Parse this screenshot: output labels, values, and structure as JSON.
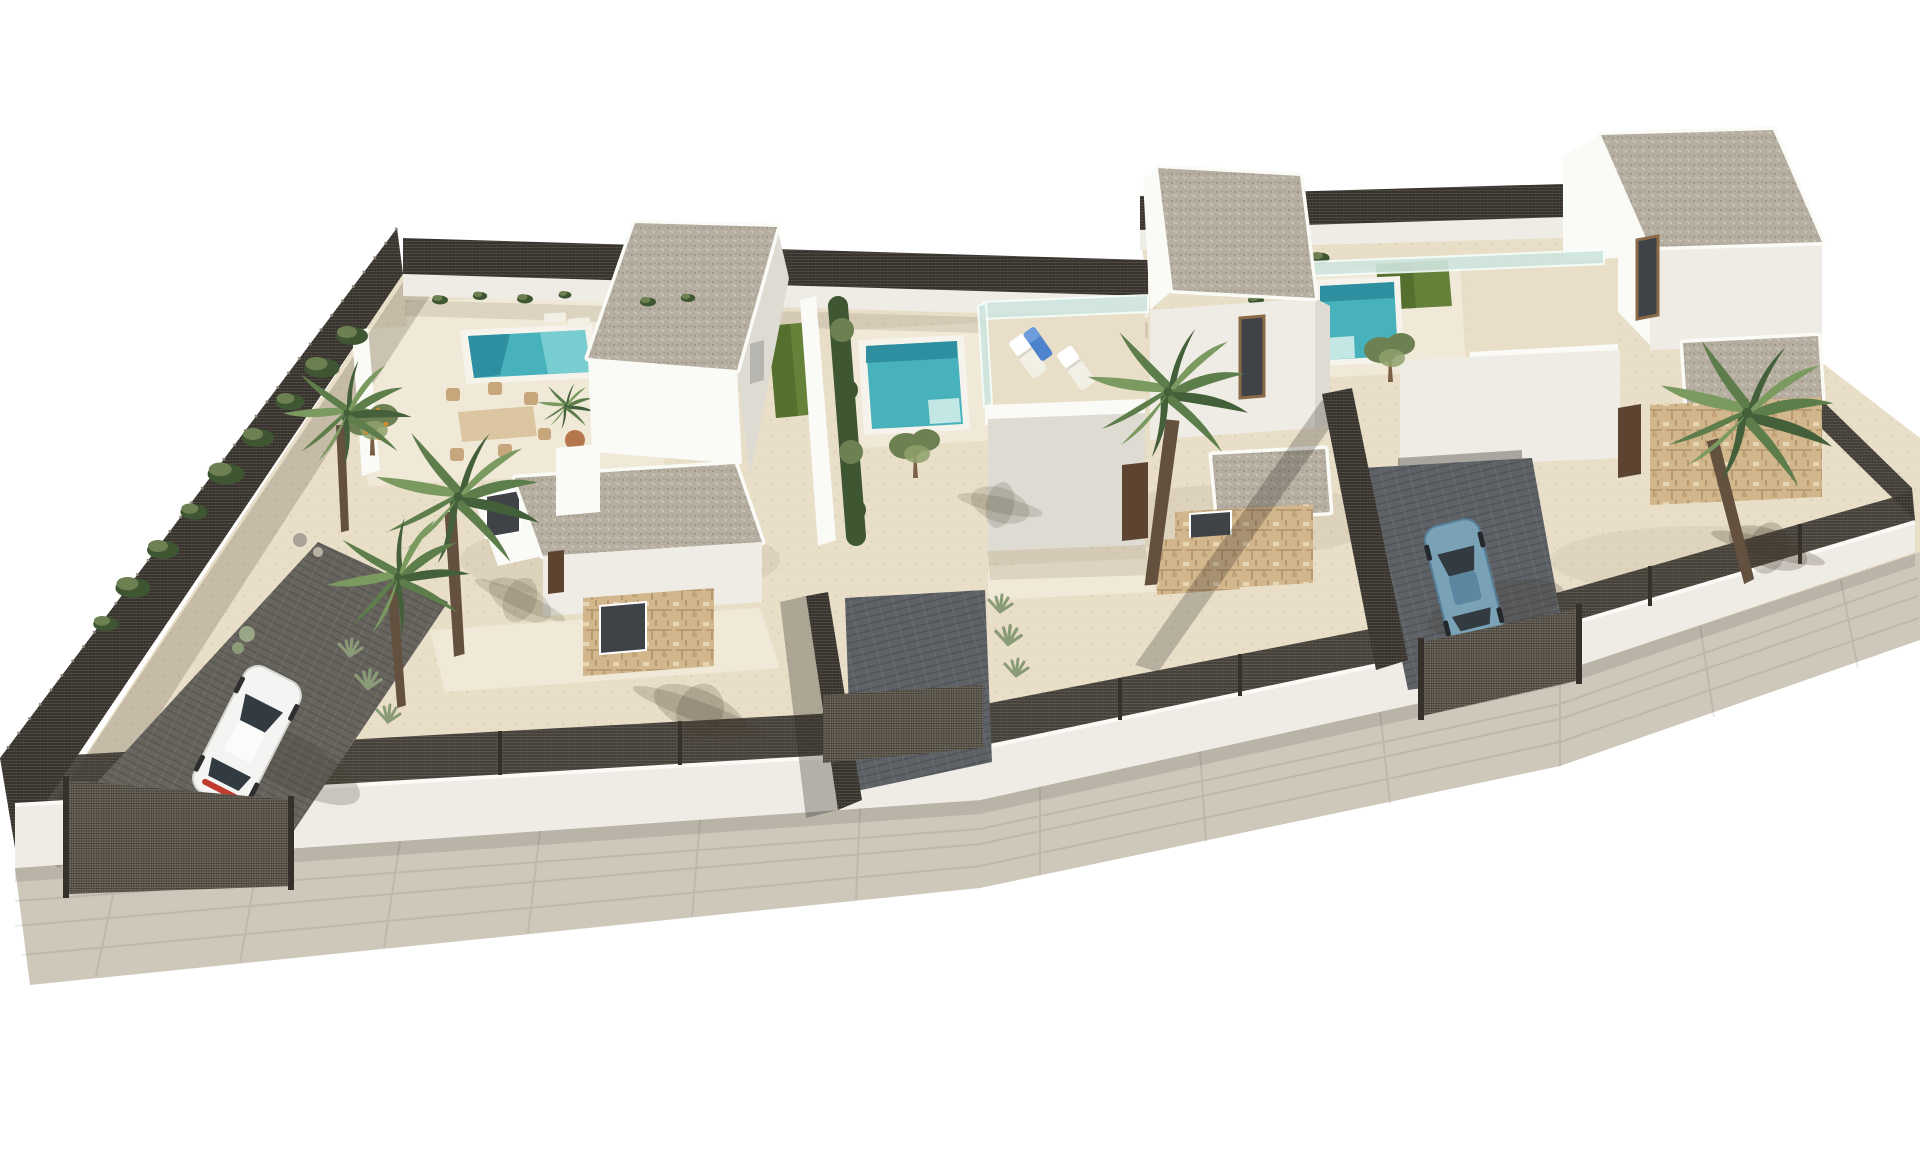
{
  "meta": {
    "description": "Aerial 3D architectural rendering of three modern two-storey white villas on a single walled plot, each with a flat gravel roof, private plunge pool, sandy gravel garden, palm and olive trees; dark mesh fencing surrounds the plot, a white car is parked in the left driveway and a blue car in the right driveway, with a light grey sidewalk along the street edge on a pure white background."
  },
  "colors": {
    "bg": "#ffffff",
    "sand": "#e9dfc9",
    "sandShade": "#d8ccb1",
    "slab": "#f1e9d7",
    "wallLit": "#fafaf7",
    "wallFace": "#efece5",
    "wallShade": "#dedbd3",
    "wallDark": "#3f4347",
    "roofGravel": "#b6afa1",
    "gravelDot": "#98907f",
    "gravelDot2": "#d9d4c8",
    "glass": "#cfe5df",
    "pool": "#47b2bb",
    "poolDark": "#2d8fa0",
    "poolLight": "#85d3d6",
    "poolStep": "#c2e7e4",
    "lawn": "#66813a",
    "lawnDark": "#55702e",
    "hedge": "#3f5633",
    "olive": "#6d8052",
    "oliveLight": "#8ea06b",
    "palmDark": "#44603a",
    "palmMid": "#5d7d4b",
    "palmLight": "#7a9a60",
    "palmTrunk": "#63503e",
    "treeTrunk": "#7b5f45",
    "fence": "#35312a",
    "gate": "#6e685c",
    "driveDark": "#5e6267",
    "driveBrown": "#67645e",
    "pavement": "#cec8bb",
    "stone": "#d2b68c",
    "stoneLine": "#b2946c",
    "carWhite": "#f4f4f2",
    "carBlue": "#7aa2b6",
    "carBlueDark": "#5c87a0",
    "carGlass": "#333b42",
    "tailRed": "#c03a2e",
    "table": "#dcc6a2",
    "chair": "#c7a67c",
    "pot": "#b5764d",
    "shadow": "rgba(70,60,45,0.22)",
    "fruit": "#d98a2b"
  },
  "scene": {
    "setting": "walled residential plot with sand and gravel landscaping",
    "villas": [
      {
        "id": "villa-left",
        "storeys": 2,
        "roof": "flat gravel",
        "features": [
          "private pool",
          "outdoor dining set with chairs",
          "potted palm",
          "stone-clad facade base",
          "driveway with white car",
          "palm trees",
          "fruit tree"
        ]
      },
      {
        "id": "villa-middle",
        "storeys": 2,
        "roof": "flat gravel",
        "features": [
          "plunge pool",
          "lawn strip",
          "cypress hedge",
          "roof terrace with two white sun loungers and one blue lounger",
          "glass balustrade",
          "olive tree",
          "palm tree"
        ]
      },
      {
        "id": "villa-right",
        "storeys": 2,
        "roof": "flat gravel",
        "features": [
          "plunge pool",
          "lawn strip",
          "roof terrace with glass balustrade",
          "stone-clad annexes",
          "driveway with blue car",
          "olive tree",
          "palm tree"
        ]
      }
    ],
    "cars": [
      {
        "color_name": "white",
        "location": "left driveway"
      },
      {
        "color_name": "steel blue",
        "location": "right driveway"
      }
    ],
    "boundary": {
      "type": "white wall with dark metal mesh fencing and gates",
      "gates": 3
    },
    "street": {
      "sidewalk": "light grey paved strip along the lower edge"
    }
  }
}
